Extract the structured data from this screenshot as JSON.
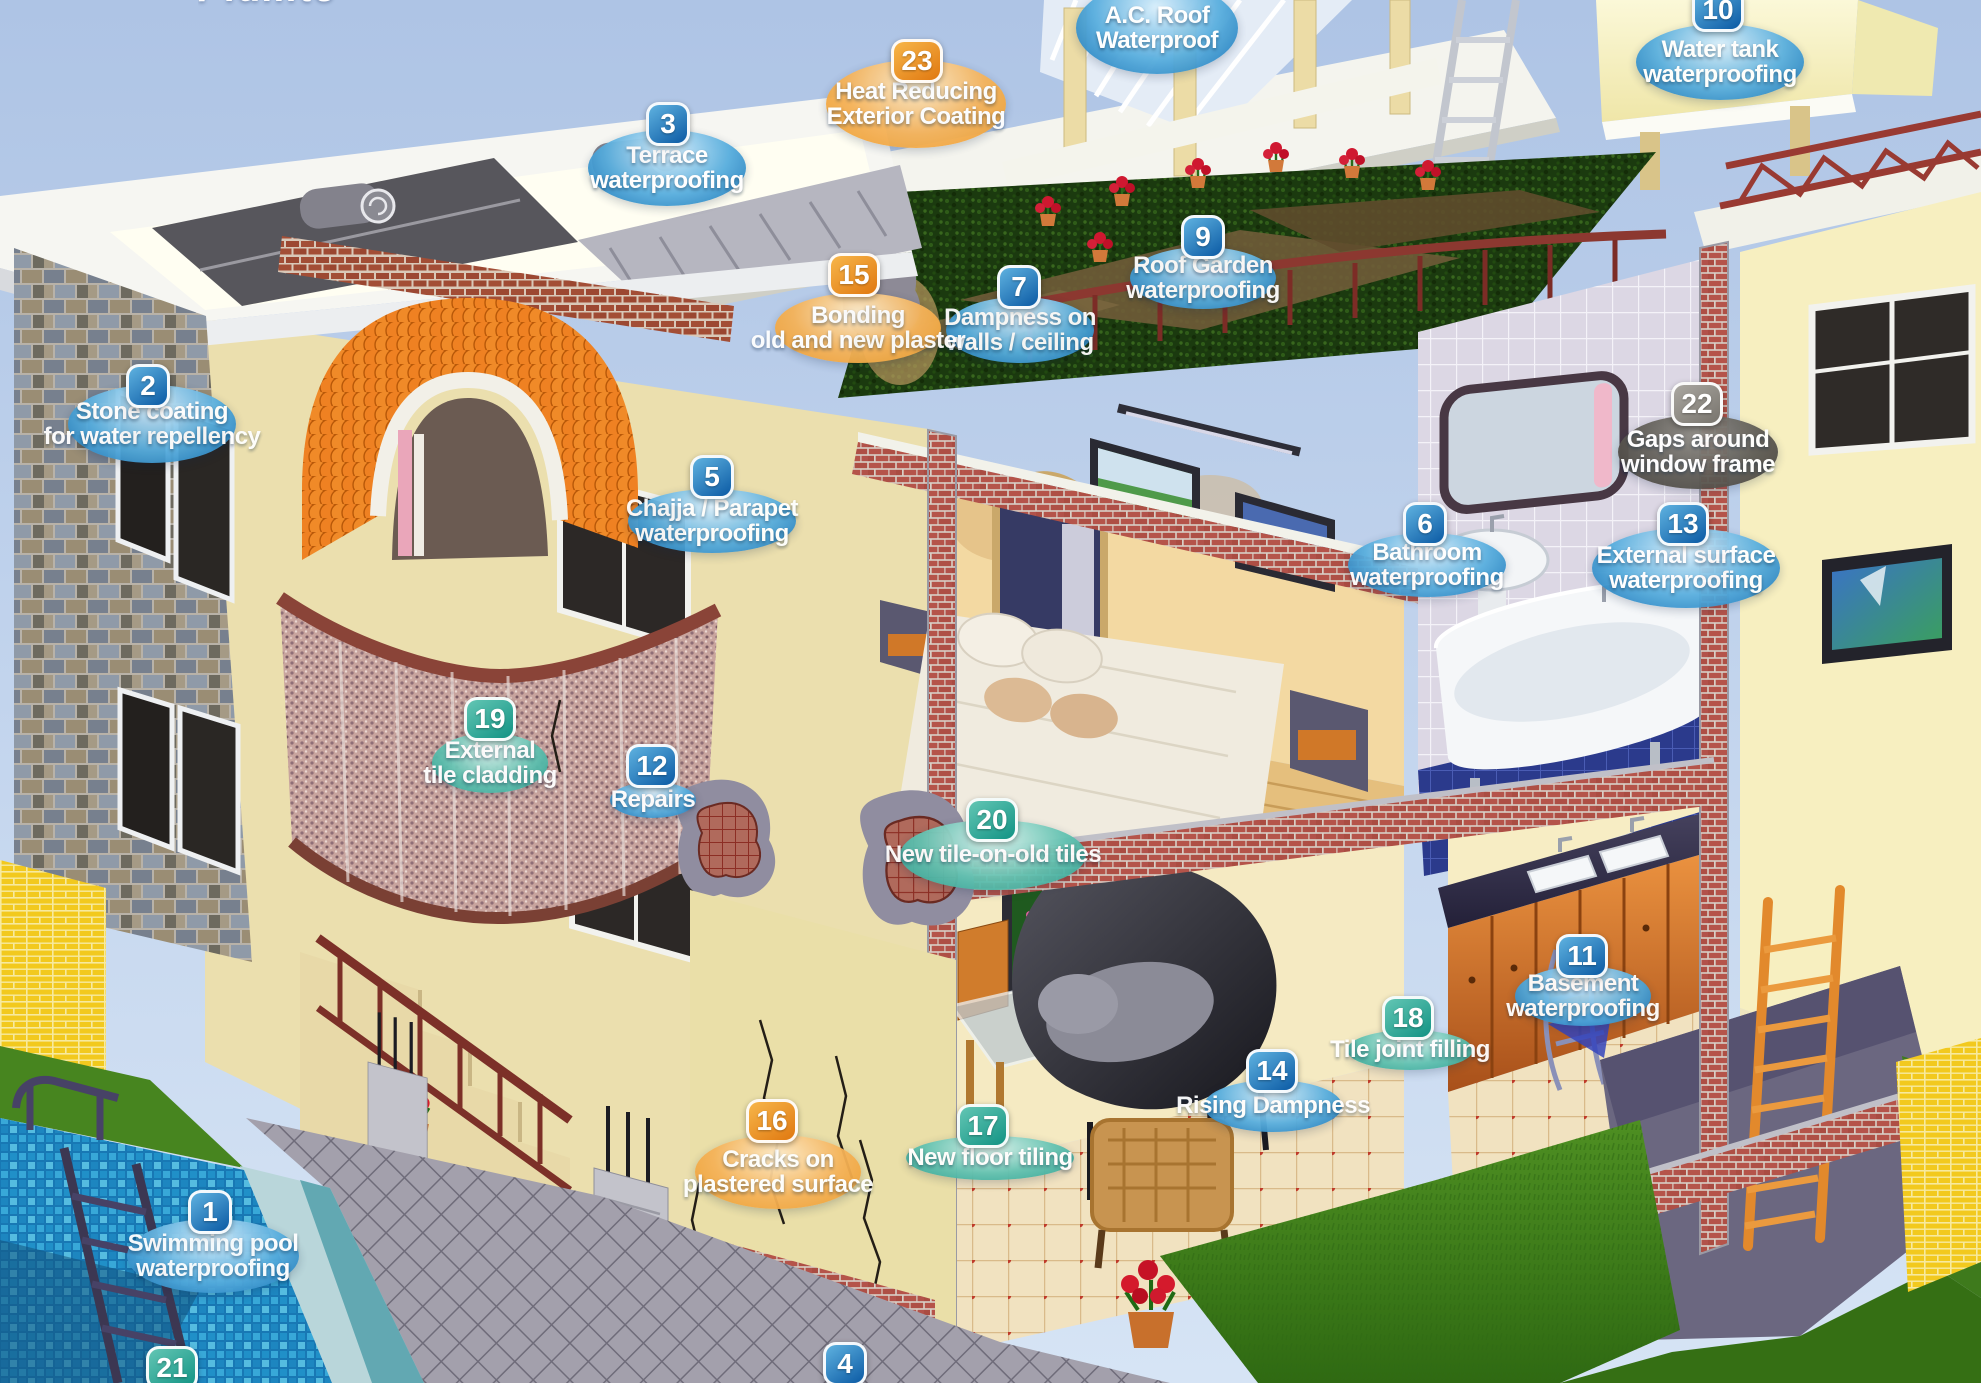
{
  "brand": {
    "logo_text": "Pidilite"
  },
  "schemes": {
    "blue": {
      "badge": [
        "#5fb2e0",
        "#0b5aa4"
      ],
      "ellipse": [
        "#d9effc",
        "#58aede",
        "#1470b4"
      ],
      "text": "#ffffff"
    },
    "orange": {
      "badge": [
        "#f7b64a",
        "#e07810"
      ],
      "ellipse": [
        "#fdeccb",
        "#f5b258",
        "#ec9c2c"
      ],
      "text": "#ffffff"
    },
    "teal": {
      "badge": [
        "#63c6b4",
        "#129384"
      ],
      "ellipse": [
        "#daf3ee",
        "#62c2b1",
        "#2aa092"
      ],
      "text": "#ffffff"
    },
    "gray": {
      "badge": [
        "#aaa7a1",
        "#78746d"
      ],
      "ellipse": [
        "#8f8c86",
        "#5e5b55",
        "#46433e"
      ],
      "text": "#ffffff"
    }
  },
  "labels": [
    {
      "number": "1",
      "lines": [
        "Swimming pool",
        "waterproofing"
      ],
      "scheme": "blue",
      "ellipse": {
        "x": 213,
        "y": 1256,
        "w": 172,
        "h": 74
      },
      "badge": {
        "x": 210,
        "y": 1212
      }
    },
    {
      "number": "2",
      "lines": [
        "Stone coating",
        "for water repellency"
      ],
      "scheme": "blue",
      "ellipse": {
        "x": 152,
        "y": 424,
        "w": 168,
        "h": 78
      },
      "badge": {
        "x": 148,
        "y": 386
      }
    },
    {
      "number": "3",
      "lines": [
        "Terrace",
        "waterproofing"
      ],
      "scheme": "blue",
      "ellipse": {
        "x": 667,
        "y": 168,
        "w": 158,
        "h": 76
      },
      "badge": {
        "x": 668,
        "y": 124
      }
    },
    {
      "number": "4",
      "lines": [],
      "scheme": "blue",
      "badge": {
        "x": 845,
        "y": 1364
      }
    },
    {
      "number": "5",
      "lines": [
        "Chajja / Parapet",
        "waterproofing"
      ],
      "scheme": "blue",
      "ellipse": {
        "x": 712,
        "y": 521,
        "w": 168,
        "h": 64
      },
      "badge": {
        "x": 712,
        "y": 477
      }
    },
    {
      "number": "6",
      "lines": [
        "Bathroom",
        "waterproofing"
      ],
      "scheme": "blue",
      "ellipse": {
        "x": 1427,
        "y": 565,
        "w": 158,
        "h": 64
      },
      "badge": {
        "x": 1425,
        "y": 524
      }
    },
    {
      "number": "7",
      "lines": [
        "Dampness on",
        "walls / ceiling"
      ],
      "scheme": "blue",
      "ellipse": {
        "x": 1020,
        "y": 330,
        "w": 148,
        "h": 66
      },
      "badge": {
        "x": 1019,
        "y": 287
      }
    },
    {
      "number": "9",
      "lines": [
        "Roof Garden",
        "waterproofing"
      ],
      "scheme": "blue",
      "ellipse": {
        "x": 1203,
        "y": 278,
        "w": 146,
        "h": 62
      },
      "badge": {
        "x": 1203,
        "y": 237
      }
    },
    {
      "number": "10",
      "lines": [
        "Water tank",
        "waterproofing"
      ],
      "scheme": "blue",
      "ellipse": {
        "x": 1720,
        "y": 62,
        "w": 168,
        "h": 76
      },
      "badge": {
        "x": 1718,
        "y": 10
      }
    },
    {
      "number": "11",
      "lines": [
        "Basement",
        "waterproofing"
      ],
      "scheme": "blue",
      "ellipse": {
        "x": 1583,
        "y": 996,
        "w": 136,
        "h": 60
      },
      "badge": {
        "x": 1582,
        "y": 956
      }
    },
    {
      "number": "12",
      "lines": [
        "Repairs"
      ],
      "scheme": "blue",
      "ellipse": {
        "x": 653,
        "y": 800,
        "w": 86,
        "h": 36
      },
      "badge": {
        "x": 652,
        "y": 766
      }
    },
    {
      "number": "13",
      "lines": [
        "External surface",
        "waterproofing"
      ],
      "scheme": "blue",
      "ellipse": {
        "x": 1686,
        "y": 568,
        "w": 188,
        "h": 80
      },
      "badge": {
        "x": 1683,
        "y": 524
      }
    },
    {
      "number": "14",
      "lines": [
        "Rising Dampness"
      ],
      "scheme": "blue",
      "ellipse": {
        "x": 1273,
        "y": 1106,
        "w": 138,
        "h": 52
      },
      "badge": {
        "x": 1272,
        "y": 1071
      }
    },
    {
      "number": "15",
      "lines": [
        "Bonding",
        "old and new plaster"
      ],
      "scheme": "orange",
      "ellipse": {
        "x": 858,
        "y": 328,
        "w": 166,
        "h": 70
      },
      "badge": {
        "x": 854,
        "y": 275
      }
    },
    {
      "number": "16",
      "lines": [
        "Cracks on",
        "plastered surface"
      ],
      "scheme": "orange",
      "ellipse": {
        "x": 778,
        "y": 1172,
        "w": 166,
        "h": 74
      },
      "badge": {
        "x": 772,
        "y": 1121
      }
    },
    {
      "number": "17",
      "lines": [
        "New floor tiling"
      ],
      "scheme": "teal",
      "ellipse": {
        "x": 990,
        "y": 1158,
        "w": 168,
        "h": 44
      },
      "badge": {
        "x": 983,
        "y": 1126
      }
    },
    {
      "number": "18",
      "lines": [
        "Tile joint filling"
      ],
      "scheme": "teal",
      "ellipse": {
        "x": 1410,
        "y": 1050,
        "w": 126,
        "h": 40
      },
      "badge": {
        "x": 1408,
        "y": 1018
      }
    },
    {
      "number": "19",
      "lines": [
        "External",
        "tile cladding"
      ],
      "scheme": "teal",
      "ellipse": {
        "x": 490,
        "y": 763,
        "w": 116,
        "h": 60
      },
      "badge": {
        "x": 490,
        "y": 719
      }
    },
    {
      "number": "20",
      "lines": [
        "New tile-on-old tiles"
      ],
      "scheme": "teal",
      "ellipse": {
        "x": 993,
        "y": 855,
        "w": 186,
        "h": 70
      },
      "badge": {
        "x": 992,
        "y": 820
      }
    },
    {
      "number": "21",
      "lines": [],
      "scheme": "teal",
      "badge": {
        "x": 172,
        "y": 1368
      }
    },
    {
      "number": "22",
      "lines": [
        "Gaps around",
        "window frame"
      ],
      "scheme": "gray",
      "ellipse": {
        "x": 1698,
        "y": 452,
        "w": 160,
        "h": 74
      },
      "badge": {
        "x": 1697,
        "y": 404
      }
    },
    {
      "number": "23",
      "lines": [
        "Heat Reducing",
        "Exterior Coating"
      ],
      "scheme": "orange",
      "ellipse": {
        "x": 916,
        "y": 104,
        "w": 180,
        "h": 88
      },
      "badge": {
        "x": 917,
        "y": 61
      }
    },
    {
      "number": "",
      "lines": [
        "A.C. Roof",
        "Waterproof"
      ],
      "scheme": "blue",
      "ellipse": {
        "x": 1157,
        "y": 28,
        "w": 162,
        "h": 92
      }
    }
  ]
}
